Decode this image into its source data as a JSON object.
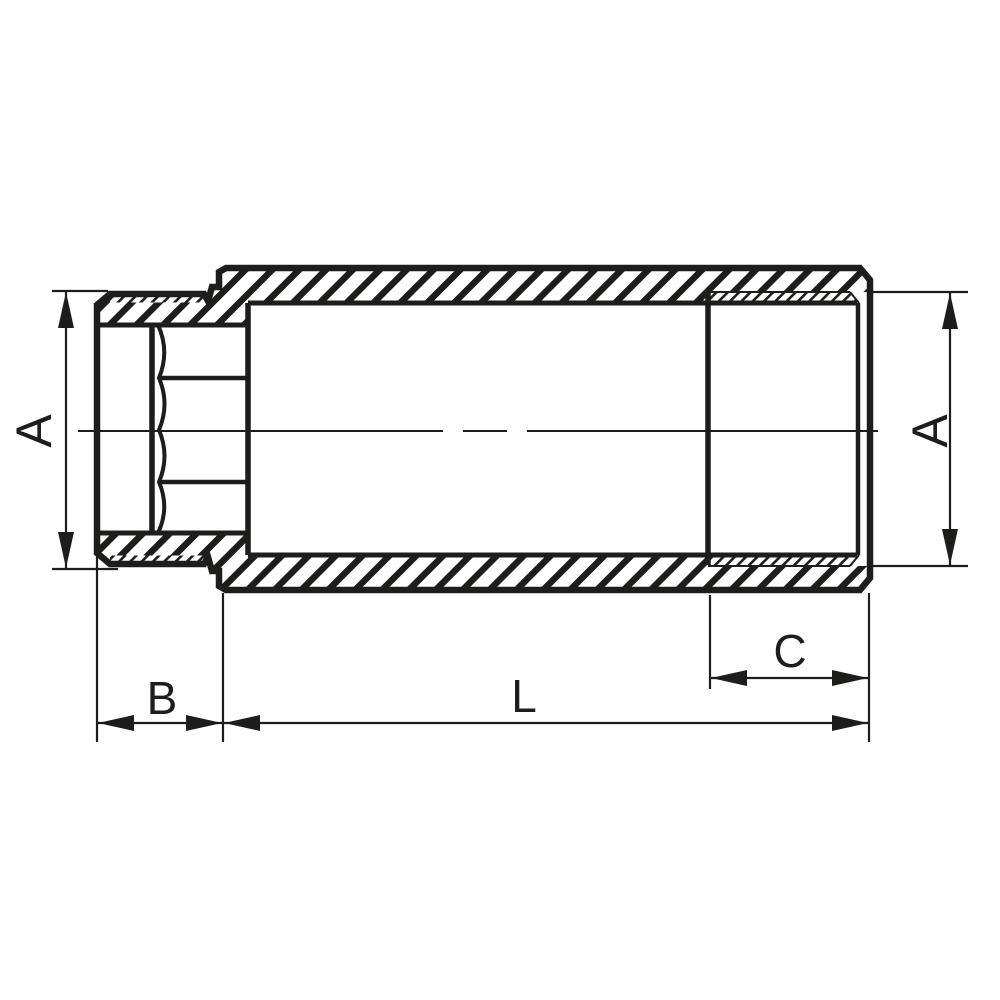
{
  "drawing": {
    "kind": "technical-cross-section",
    "colors": {
      "line": "#1d1d1b",
      "background": "#ffffff"
    },
    "labels": {
      "a_left": "A",
      "a_right": "A",
      "b": "B",
      "l": "L",
      "c": "C"
    }
  }
}
